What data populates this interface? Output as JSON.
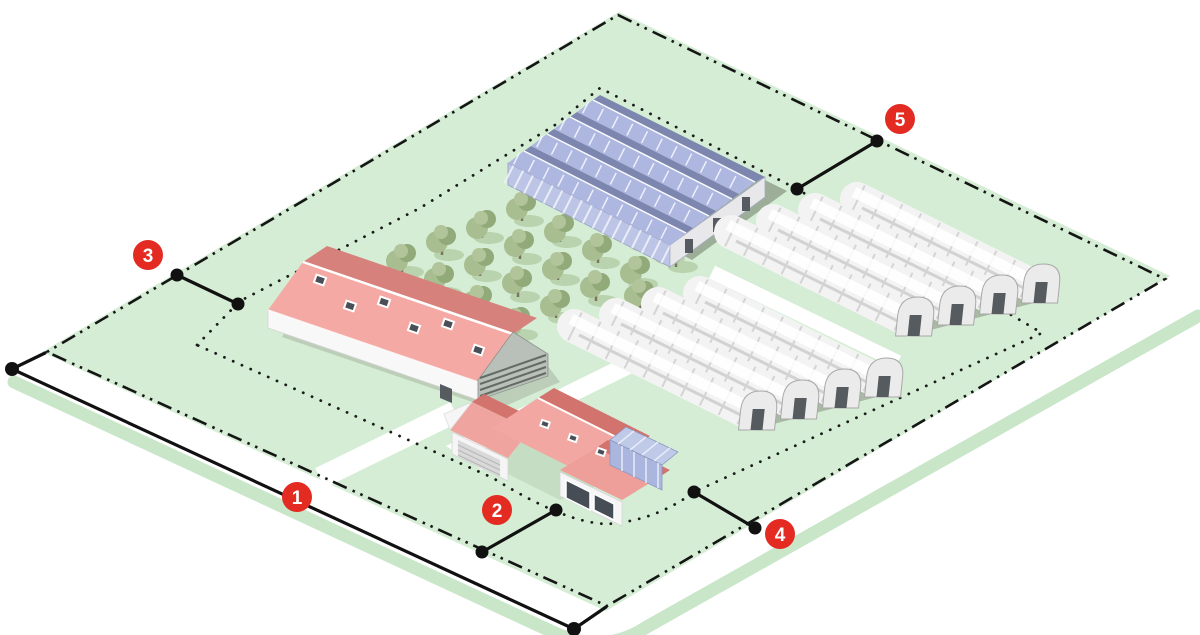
{
  "markers": [
    {
      "number": "1"
    },
    {
      "number": "2"
    },
    {
      "number": "3"
    },
    {
      "number": "4"
    },
    {
      "number": "5"
    }
  ],
  "colors": {
    "parcel_green": "#d4edd4",
    "verge_green": "#c9e6c9",
    "marker_red": "#e32b22",
    "boundary_black": "#151515",
    "roof_salmon": "#f2a7a2",
    "roof_dark_red": "#d6817b",
    "solar_panel_blue": "#aeb7df",
    "conservatory_blue": "#aab6de",
    "tunnel_white": "#f3f3f3",
    "tree_green": "#a8bd90",
    "shadow_sage": "#9cae98"
  }
}
